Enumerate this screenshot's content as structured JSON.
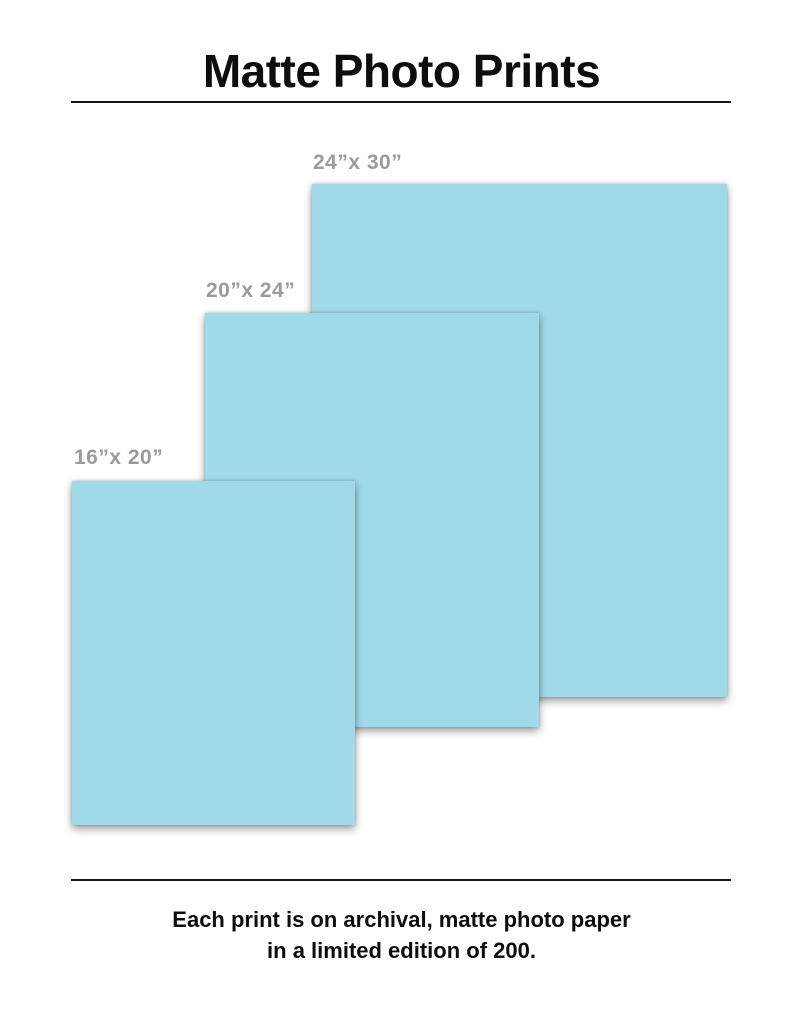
{
  "header": {
    "title": "Matte Photo Prints"
  },
  "prints": [
    {
      "id": "24x30",
      "label": "24”x 30”",
      "width_in": 24,
      "height_in": 30
    },
    {
      "id": "20x24",
      "label": "20”x 24”",
      "width_in": 20,
      "height_in": 24
    },
    {
      "id": "16x20",
      "label": "16”x 20”",
      "width_in": 16,
      "height_in": 20
    }
  ],
  "footer": {
    "line1": "Each print is on archival, matte photo paper",
    "line2": "in a limited edition of 200."
  },
  "colors": {
    "print_fill": "#9fdaeb",
    "label_text": "#9b9b9b",
    "text": "#0d0d0d",
    "rule": "#141414",
    "page_bg": "#ffffff"
  }
}
